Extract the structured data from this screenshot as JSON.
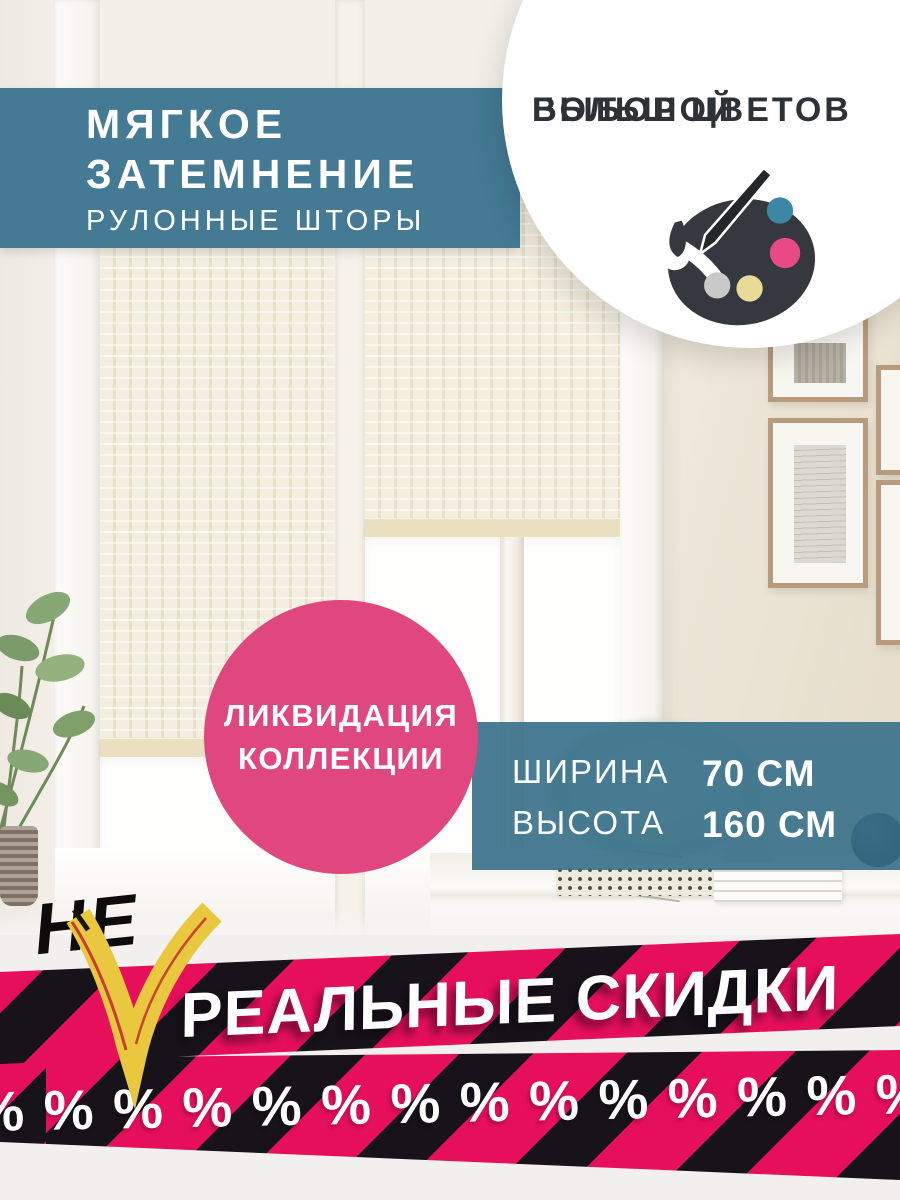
{
  "header": {
    "title_line1": "МЯГКОЕ",
    "title_line2": "ЗАТЕМНЕНИЕ",
    "subtitle": "РУЛОННЫЕ ШТОРЫ"
  },
  "color_badge": {
    "line1": "БОЛЬШОЙ",
    "line2": "ВЫБОР ЦВЕТОВ"
  },
  "palette": {
    "body": "#35383e",
    "brush": "#24262a",
    "dot_teal": "#3c87a6",
    "dot_pink": "#e84a86",
    "dot_silver": "#c9c9c9",
    "dot_yellow": "#e8db97"
  },
  "sale_circle": {
    "line1": "ЛИКВИДАЦИЯ",
    "line2": "КОЛЛЕКЦИИ"
  },
  "dimensions": {
    "width_label": "ШИРИНА",
    "width_value": "70 СМ",
    "height_label": "ВЫСОТА",
    "height_value": "160 СМ"
  },
  "promo": {
    "not_word": "НЕ",
    "slogan": "РЕАЛЬНЫЕ СКИДКИ",
    "percent_row": "% % % % % % % % % % % % % %"
  },
  "colors": {
    "header_teal": "#447a94",
    "panel_teal": "rgba(54,111,138,0.9)",
    "circle_pink": "#e0477e",
    "stripe_pink": "#e60f5b",
    "stripe_black": "#18131b",
    "badge_text": "#2e3237",
    "checkmark_yellow": "#e9c83f",
    "bottom_bg": "#f2f0ef"
  }
}
